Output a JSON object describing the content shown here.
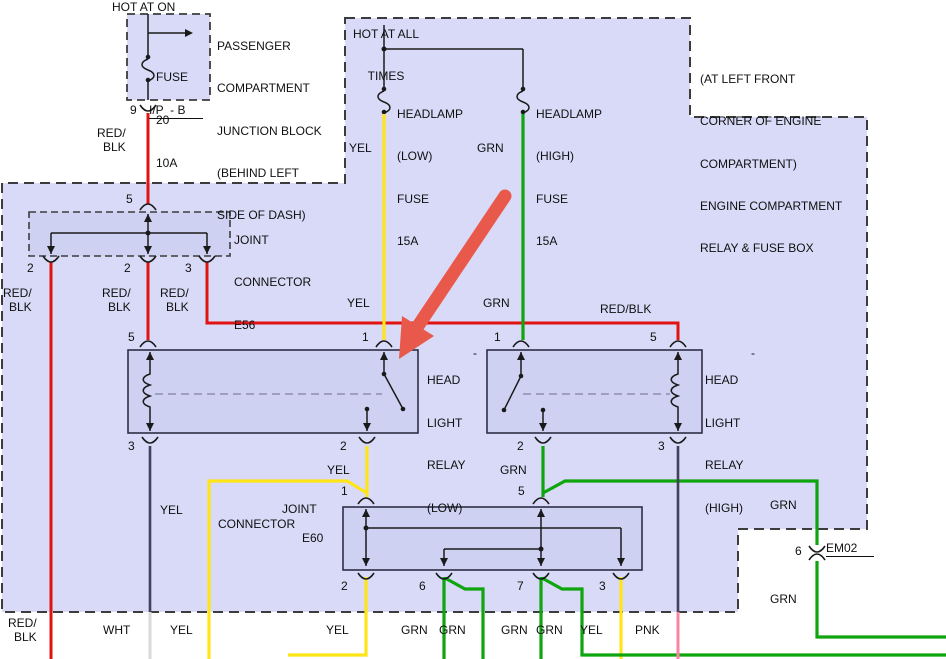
{
  "colors": {
    "region": "#d9daf7",
    "box": "#ced1f2",
    "dash": "#3c3c3c",
    "line": "#1a1a1a",
    "relay_dash": "#8d8dac",
    "red": "#e01212",
    "yellow": "#ffe417",
    "green": "#0ea50e",
    "pink": "#fb84a4",
    "slate": "#41415a",
    "light": "#d9d9d9",
    "arrow": "#e8584b"
  },
  "power": {
    "hot_at_on": "HOT AT ON",
    "hot_all_1": "HOT AT ALL",
    "hot_all_2": "TIMES"
  },
  "junction_block": {
    "desc": [
      "PASSENGER",
      "COMPARTMENT",
      "JUNCTION BLOCK",
      "(BEHIND LEFT",
      "SIDE OF DASH)"
    ],
    "fuse": [
      "FUSE",
      "20",
      "10A"
    ],
    "pin": "9",
    "connector": "I/P  - B"
  },
  "engine_box": {
    "desc": [
      "(AT LEFT FRONT",
      "CORNER OF ENGINE",
      "COMPARTMENT)",
      "ENGINE COMPARTMENT",
      "RELAY & FUSE BOX"
    ]
  },
  "fuses": {
    "low": [
      "HEADLAMP",
      "(LOW)",
      "FUSE",
      "15A"
    ],
    "high": [
      "HEADLAMP",
      "(HIGH)",
      "FUSE",
      "15A"
    ]
  },
  "relays": {
    "low": [
      "HEAD",
      "LIGHT",
      "RELAY",
      "(LOW)"
    ],
    "high": [
      "HEAD",
      "LIGHT",
      "RELAY",
      "(HIGH)"
    ],
    "dash_low": "-",
    "dash_high": "-"
  },
  "connectors": {
    "e56": [
      "JOINT",
      "CONNECTOR",
      "E56"
    ],
    "e60_joint": "JOINT",
    "e60_connector": "CONNECTOR",
    "e60_name": "E60",
    "em02": "EM02"
  },
  "wire_labels": [
    {
      "text": "RED/",
      "x": 97,
      "y": 127
    },
    {
      "text": "BLK",
      "x": 103,
      "y": 141
    },
    {
      "text": "YEL",
      "x": 349,
      "y": 142
    },
    {
      "text": "GRN",
      "x": 477,
      "y": 142
    },
    {
      "text": "RED/",
      "x": 3,
      "y": 287
    },
    {
      "text": "BLK",
      "x": 9,
      "y": 301
    },
    {
      "text": "RED/",
      "x": 102,
      "y": 287
    },
    {
      "text": "BLK",
      "x": 108,
      "y": 301
    },
    {
      "text": "RED/",
      "x": 160,
      "y": 287
    },
    {
      "text": "BLK",
      "x": 166,
      "y": 301
    },
    {
      "text": "YEL",
      "x": 347,
      "y": 297
    },
    {
      "text": "GRN",
      "x": 483,
      "y": 297
    },
    {
      "text": "RED/BLK",
      "x": 600,
      "y": 303
    },
    {
      "text": "YEL",
      "x": 327,
      "y": 464
    },
    {
      "text": "GRN",
      "x": 500,
      "y": 464
    },
    {
      "text": "YEL",
      "x": 160,
      "y": 504
    },
    {
      "text": "GRN",
      "x": 770,
      "y": 499
    },
    {
      "text": "GRN",
      "x": 770,
      "y": 593
    },
    {
      "text": "RED/",
      "x": 8,
      "y": 617
    },
    {
      "text": "BLK",
      "x": 14,
      "y": 631
    },
    {
      "text": "WHT",
      "x": 103,
      "y": 624
    },
    {
      "text": "YEL",
      "x": 170,
      "y": 624
    },
    {
      "text": "YEL",
      "x": 326,
      "y": 624
    },
    {
      "text": "GRN",
      "x": 401,
      "y": 624
    },
    {
      "text": "GRN",
      "x": 439,
      "y": 624
    },
    {
      "text": "GRN",
      "x": 501,
      "y": 624
    },
    {
      "text": "GRN",
      "x": 536,
      "y": 624
    },
    {
      "text": "YEL",
      "x": 580,
      "y": 624
    },
    {
      "text": "PNK",
      "x": 635,
      "y": 624
    }
  ],
  "pin_numbers": [
    {
      "text": "9",
      "x": 130,
      "y": 104
    },
    {
      "text": "5",
      "x": 126,
      "y": 193
    },
    {
      "text": "2",
      "x": 27,
      "y": 262
    },
    {
      "text": "2",
      "x": 124,
      "y": 262
    },
    {
      "text": "3",
      "x": 185,
      "y": 262
    },
    {
      "text": "5",
      "x": 128,
      "y": 331
    },
    {
      "text": "1",
      "x": 362,
      "y": 331
    },
    {
      "text": "1",
      "x": 494,
      "y": 331
    },
    {
      "text": "5",
      "x": 650,
      "y": 331
    },
    {
      "text": "3",
      "x": 128,
      "y": 440
    },
    {
      "text": "2",
      "x": 340,
      "y": 440
    },
    {
      "text": "2",
      "x": 517,
      "y": 440
    },
    {
      "text": "3",
      "x": 658,
      "y": 440
    },
    {
      "text": "1",
      "x": 341,
      "y": 485
    },
    {
      "text": "5",
      "x": 518,
      "y": 485
    },
    {
      "text": "2",
      "x": 341,
      "y": 580
    },
    {
      "text": "6",
      "x": 419,
      "y": 580
    },
    {
      "text": "7",
      "x": 517,
      "y": 580
    },
    {
      "text": "3",
      "x": 599,
      "y": 580
    },
    {
      "text": "6",
      "x": 795,
      "y": 545
    }
  ]
}
